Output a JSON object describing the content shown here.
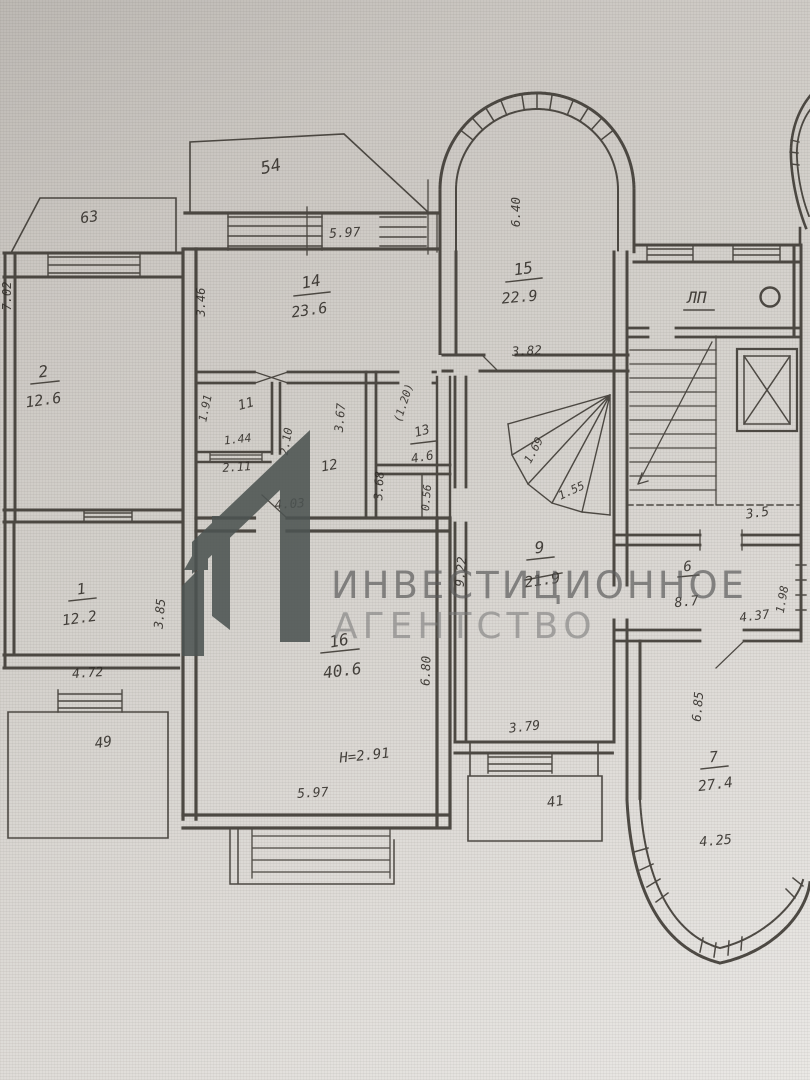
{
  "watermark": {
    "line1": "ИНВЕСТИЦИОННОЕ",
    "line2": "АГЕНТСТВО",
    "logo_color": "#4d5452",
    "text_color": "#6e6e6e"
  },
  "plan": {
    "stairwell_label": "ЛП",
    "height_note": "Н=2.91",
    "rooms": {
      "r1": {
        "number": "1",
        "area": "12.2"
      },
      "r2": {
        "number": "2",
        "area": "12.6"
      },
      "r6": {
        "number": "6",
        "area": "8.7"
      },
      "r7": {
        "number": "7",
        "area": "27.4"
      },
      "r9": {
        "number": "9",
        "area": "21.9"
      },
      "r11": {
        "number": "11"
      },
      "r12": {
        "number": "12"
      },
      "r13": {
        "number": "13",
        "area": "4.6"
      },
      "r14": {
        "number": "14",
        "area": "23.6"
      },
      "r15": {
        "number": "15",
        "area": "22.9"
      },
      "r16": {
        "number": "16",
        "area": "40.6"
      }
    },
    "balconies": {
      "b54": "54",
      "b63": "63",
      "b49": "49",
      "b41": "41"
    },
    "dims": {
      "d597t": "5.97",
      "d346": "3.46",
      "d702": "7.02",
      "d640": "6.40",
      "d382": "3.82",
      "d191": "1.91",
      "d144": "1.44",
      "d211": "2.11",
      "d210": "2.10",
      "d367": "3.67",
      "d368": "3.68",
      "d403": "4.03",
      "d120": "(1.20)",
      "d056": "0.56",
      "d169": "1.69",
      "d155": "1.55",
      "d922": "9.22",
      "d35": "3.5",
      "d437": "4.37",
      "d198": "1.98",
      "d680": "6.80",
      "d597b": "5.97",
      "d379": "3.79",
      "d685": "6.85",
      "d425": "4.25",
      "d385": "3.85",
      "d472": "4.72"
    }
  }
}
